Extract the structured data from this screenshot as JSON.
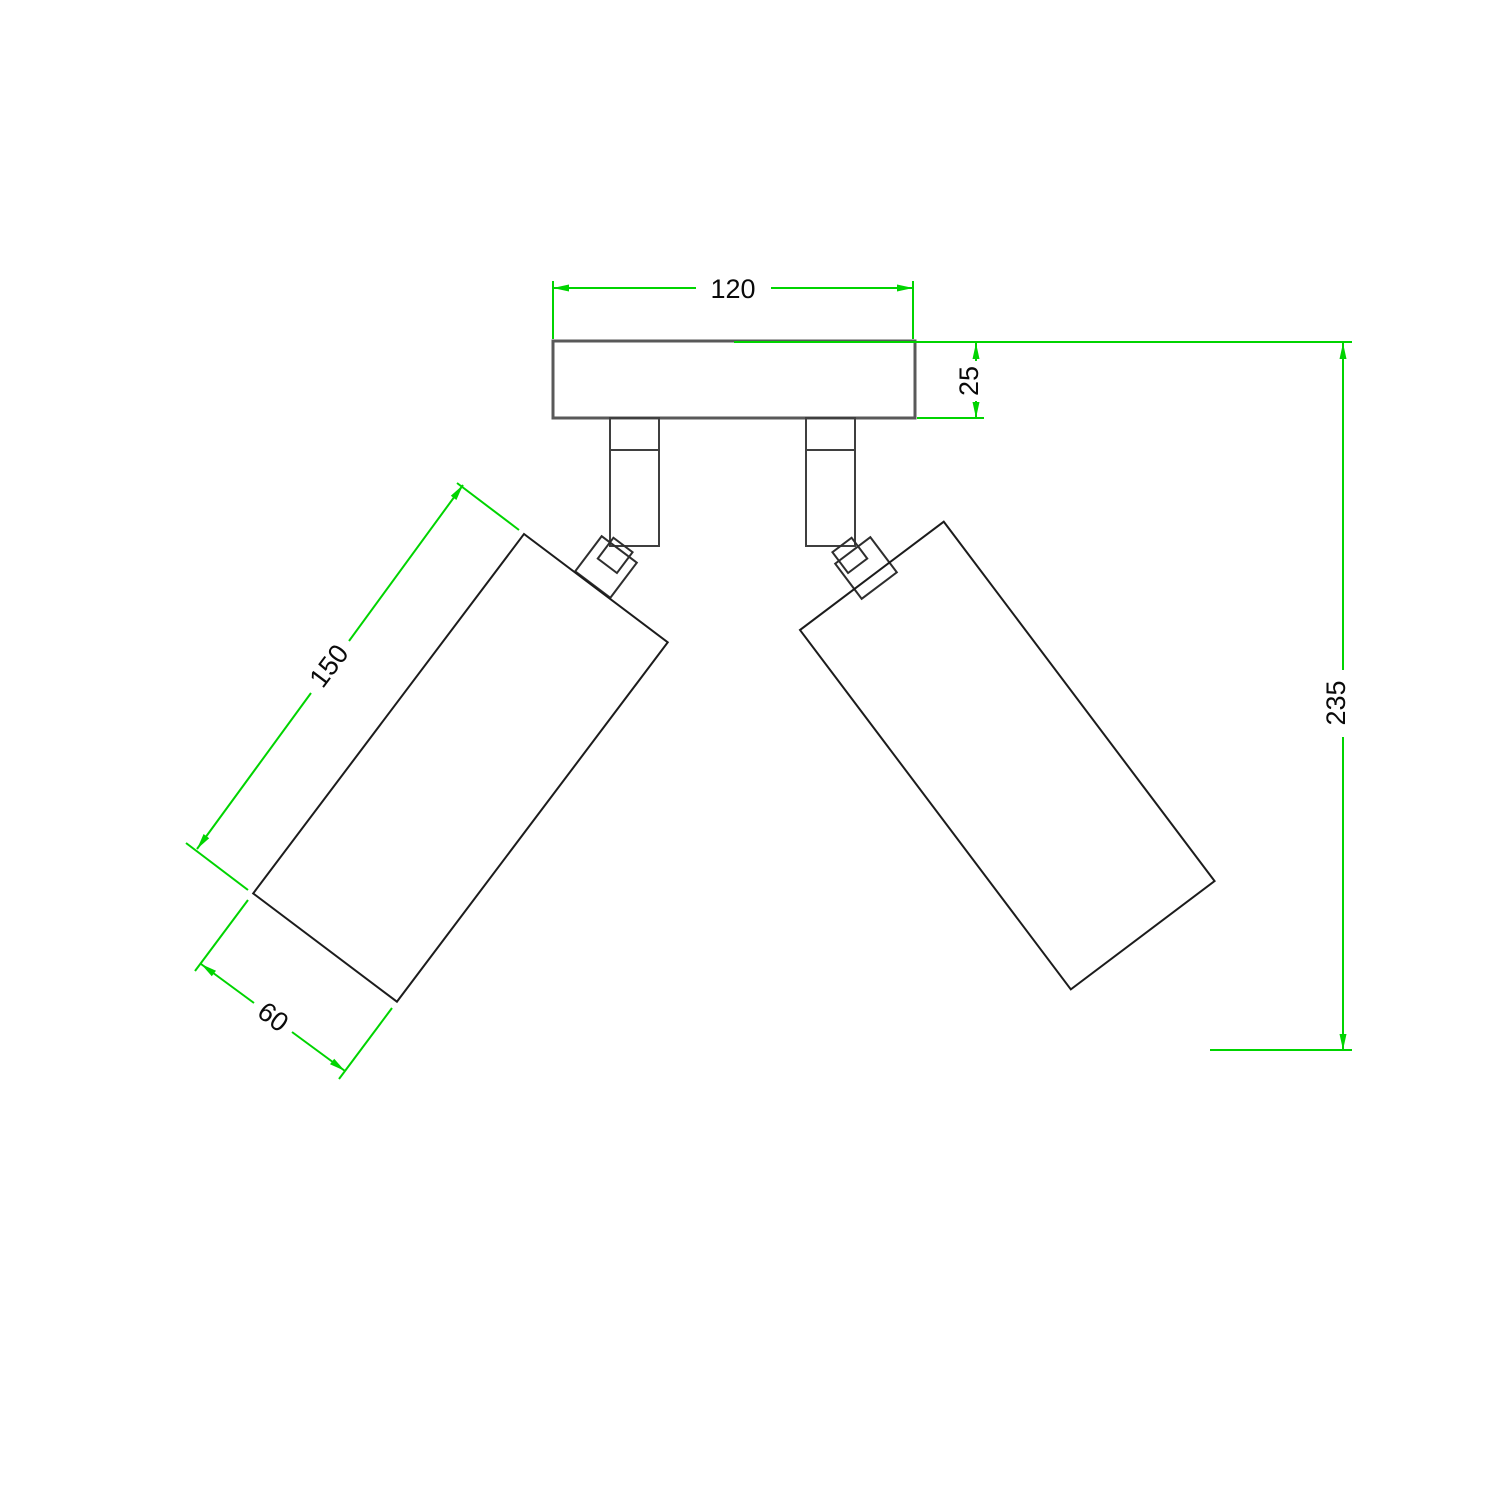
{
  "drawing": {
    "type": "technical-dimension-drawing",
    "subject": "ceiling-mounted double adjustable spotlight, side elevation",
    "dimensions": {
      "plate_width": "120",
      "plate_thickness": "25",
      "spot_body_length": "150",
      "spot_body_diameter": "60",
      "overall_depth": "235"
    },
    "colors": {
      "dimension_lines": "#00d400",
      "body_outline": "#1c1c1c",
      "plate_outline": "#595959",
      "background": "#ffffff"
    }
  }
}
